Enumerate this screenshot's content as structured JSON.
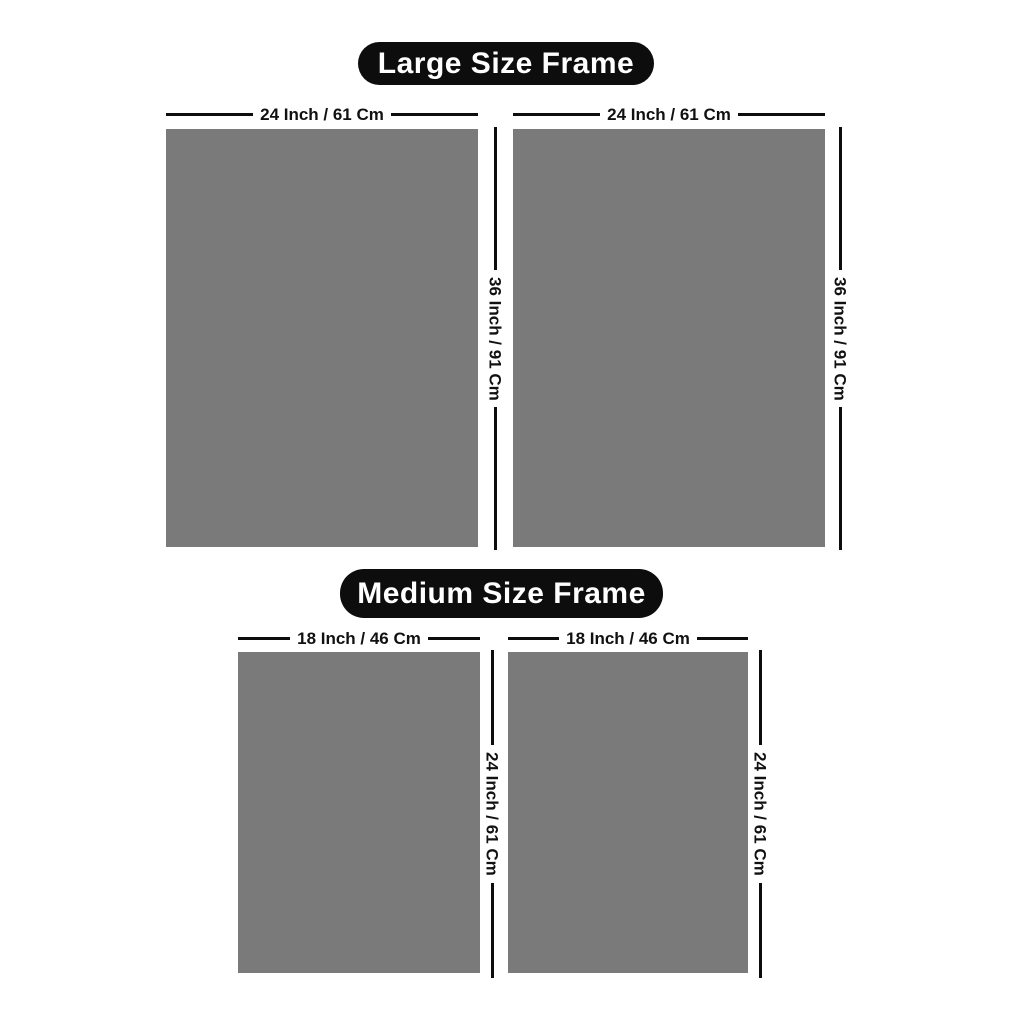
{
  "colors": {
    "page_bg": "#ffffff",
    "frame_fill": "#7a7a7a",
    "line_color": "#0d0d0d",
    "pill_bg": "#0d0d0d",
    "pill_text": "#ffffff",
    "label_text": "#111111"
  },
  "sections": [
    {
      "title": "Large Size Frame",
      "frames": [
        {
          "width_label": "24 Inch / 61 Cm",
          "height_label": "36 Inch / 91 Cm"
        },
        {
          "width_label": "24 Inch / 61 Cm",
          "height_label": "36 Inch / 91 Cm"
        }
      ]
    },
    {
      "title": "Medium Size Frame",
      "frames": [
        {
          "width_label": "18 Inch / 46 Cm",
          "height_label": "24 Inch / 61 Cm"
        },
        {
          "width_label": "18 Inch / 46 Cm",
          "height_label": "24 Inch / 61 Cm"
        }
      ]
    }
  ]
}
